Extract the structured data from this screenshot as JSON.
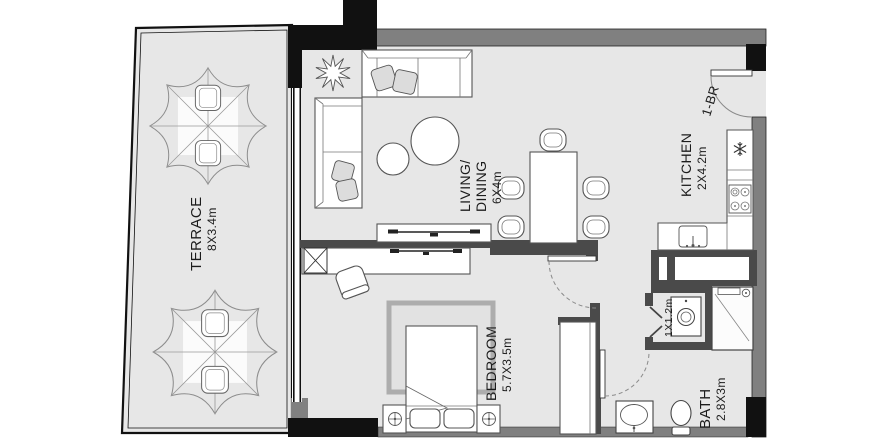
{
  "unit": {
    "label": "1-BR"
  },
  "rooms": {
    "terrace": {
      "name": "TERRACE",
      "dims": "8X3.4m"
    },
    "living": {
      "name_line1": "LIVING/",
      "name_line2": "DINING",
      "dims": "6X4m"
    },
    "kitchen": {
      "name": "KITCHEN",
      "dims": "2X4.2m"
    },
    "bedroom": {
      "name": "BEDROOM",
      "dims": "5.7X3.5m"
    },
    "bath": {
      "name": "BATH",
      "dims": "2.8X3m"
    },
    "utility": {
      "dims": "1X1.2m"
    }
  },
  "colors": {
    "background": "#ffffff",
    "floor": "#e7e7e7",
    "wall_gray": "#808080",
    "wall_dark": "#4a4a4a",
    "wall_black": "#111111",
    "furniture_line": "#555555",
    "rug_border": "#adadad",
    "label_text": "#1c1c1c"
  }
}
